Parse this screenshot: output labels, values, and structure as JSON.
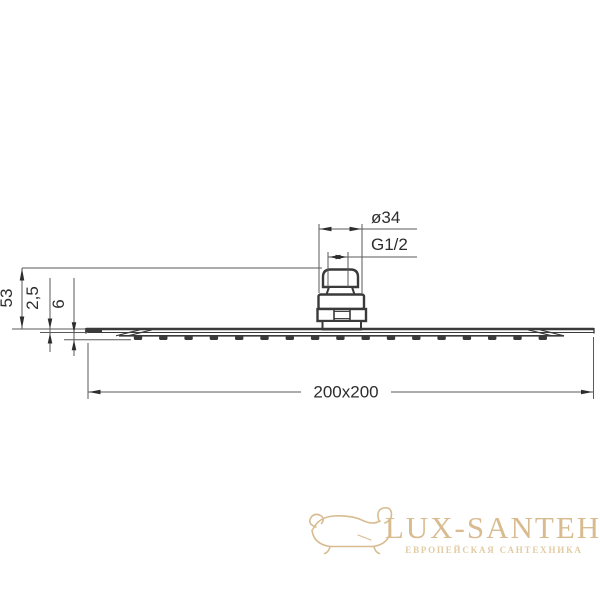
{
  "diagram": {
    "kind": "technical-drawing-side-view-rain-shower-head",
    "dimensions": {
      "connector_diameter": "ø34",
      "thread": "G1/2",
      "total_height": "53",
      "edge_thickness": "2,5",
      "plate_thickness": "6",
      "plate_size": "200x200"
    },
    "colors": {
      "outline": "#3a3a3a",
      "dimension_line": "#5a5a5a",
      "text": "#2d2d2d"
    }
  },
  "watermark": {
    "brand": "LUX-SANTEH",
    "tagline": "ЕВРОПЕЙСКАЯ САНТЕХНИКА",
    "icon": "bathtub-icon",
    "color": "#d8bc90"
  }
}
